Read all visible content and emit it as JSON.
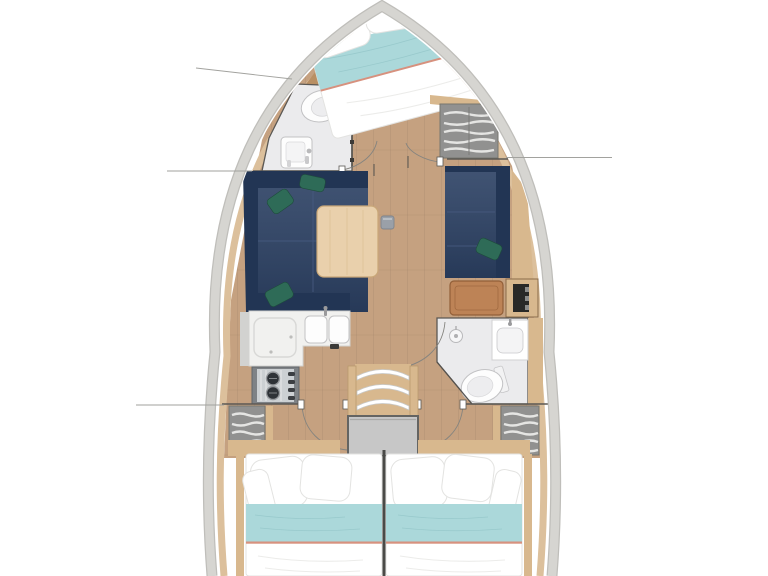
{
  "document": {
    "title": "Sailing yacht interior layout floor plan (top view)"
  },
  "colors": {
    "hull_band": "#d6d5d1",
    "hull_edge": "#bfbeba",
    "lining_wood": "#dcc09c",
    "floor_wood": "#c5a180",
    "floor_seam": "#a98a6c",
    "trim_wood": "#d8b88e",
    "bow_wood": "#b98f63",
    "table_wood": "#e9d0ac",
    "table_edge": "#c9a778",
    "sofa_navy": "#2c4164",
    "sofa_navy_dark": "#223554",
    "cushion_green": "#2e6b57",
    "berth_teal": "#abd8da",
    "stripe_coral": "#d7917e",
    "linen_shadow": "#e3e3e1",
    "bath_floor": "#ebebed",
    "fixture_edge": "#c2c2c4",
    "wall": "#5b5854",
    "counter": "#f1f1ef",
    "counter_edge": "#d2d2d0",
    "stove_frame": "#7e8286",
    "stove_panel": "#ccd0d3",
    "burner": "#2e3237",
    "locker_gray": "#919190",
    "slat_white": "#eaeae8",
    "engine_gray": "#c7c7c7",
    "engine_edge": "#646462",
    "seat_brown": "#bd8356",
    "seat_brown_edge": "#925f38",
    "cabinet_dark": "#292927",
    "divider": "#4a4a47",
    "callout": "#a2a29e"
  },
  "boat": {
    "view": "overhead deck plan",
    "areas": [
      {
        "name": "forward-cabin",
        "items": [
          "angled-double-berth",
          "white-pillows",
          "teal-blanket-with-coral-stripe",
          "bow-wood-locker"
        ]
      },
      {
        "name": "forward-head",
        "items": [
          "toilet",
          "washbasin-cabinet",
          "door"
        ]
      },
      {
        "name": "forward-wardrobe",
        "items": [
          "shelved-locker"
        ]
      },
      {
        "name": "salon",
        "items": [
          "u-shaped-sofa-port",
          "wood-dining-table",
          "table-support",
          "settee-starboard",
          "green-scatter-cushions"
        ]
      },
      {
        "name": "nav-area",
        "items": [
          "brown-seat",
          "cabinet-with-panel"
        ]
      },
      {
        "name": "galley",
        "items": [
          "l-shaped-counter",
          "top-loading-fridge",
          "double-sink",
          "two-burner-stove"
        ]
      },
      {
        "name": "aft-head",
        "items": [
          "shower-head",
          "washbasin",
          "toilet",
          "door"
        ]
      },
      {
        "name": "companionway",
        "items": [
          "three-steps",
          "engine-box"
        ]
      },
      {
        "name": "midship-lockers",
        "items": [
          "port-shelved-locker",
          "starboard-shelved-locker"
        ]
      },
      {
        "name": "aft-cabin-port",
        "items": [
          "double-berth",
          "white-pillows",
          "teal-blanket-with-coral-stripe"
        ]
      },
      {
        "name": "aft-cabin-starboard",
        "items": [
          "double-berth",
          "white-pillows",
          "teal-blanket-with-coral-stripe"
        ]
      }
    ],
    "callout_leader_lines": 6
  }
}
